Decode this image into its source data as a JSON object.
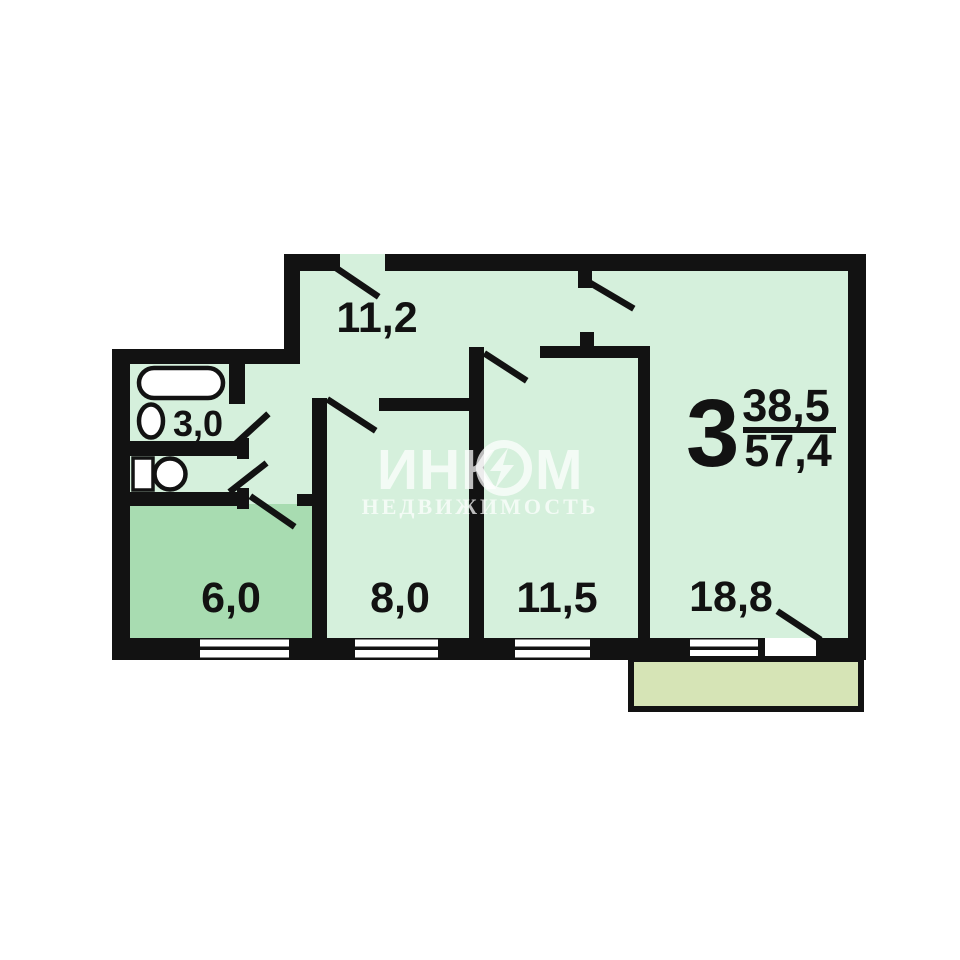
{
  "document_type": "apartment-floor-plan",
  "rooms": [
    {
      "id": "hallway",
      "area": "11,2"
    },
    {
      "id": "bathroom",
      "area": "3,0"
    },
    {
      "id": "kitchen",
      "area": "6,0"
    },
    {
      "id": "room-small",
      "area": "8,0"
    },
    {
      "id": "room-middle",
      "area": "11,5"
    },
    {
      "id": "room-large",
      "area": "18,8"
    }
  ],
  "summary": {
    "rooms_count": "3",
    "living_area": "38,5",
    "total_area": "57,4"
  },
  "watermark": {
    "brand_start": "ИНК",
    "brand_end": "М",
    "subtitle": "НЕДВИЖИМОСТЬ"
  },
  "colors": {
    "wall": "#121212",
    "floor": "#d5f0dc",
    "kitchen_floor": "#a8dcb1",
    "balcony_floor": "#d6e4b6",
    "window_fill": "#ffffff",
    "fixture_fill": "#ffffff",
    "label_text": "#121212",
    "watermark_text": "rgba(255,255,255,0.72)"
  }
}
